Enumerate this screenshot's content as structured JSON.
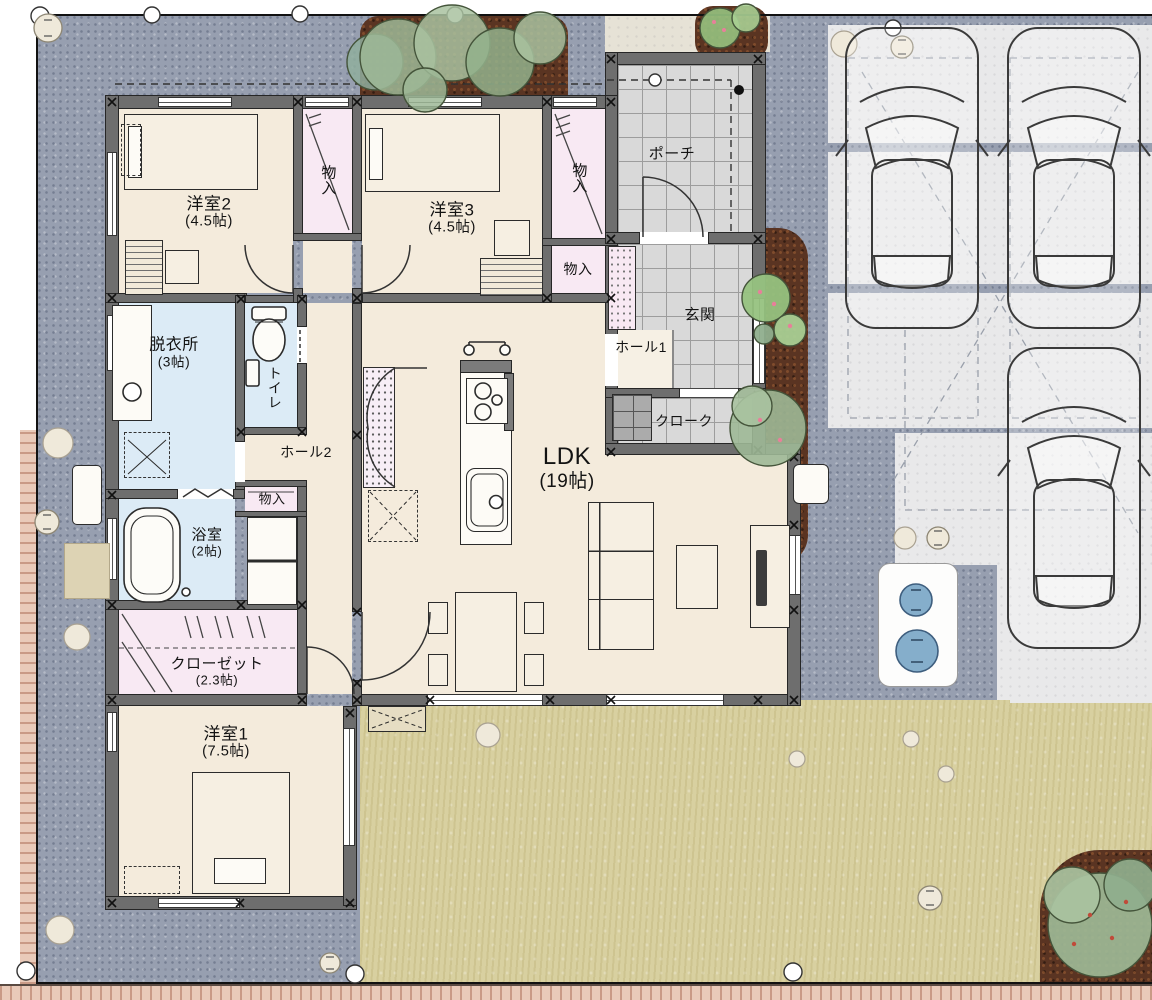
{
  "plan_type": "1F間取り図",
  "rooms": [
    {
      "id": "yoshitsu2",
      "name": "洋室2",
      "size": "(4.5帖)"
    },
    {
      "id": "mono_a",
      "name": "物入",
      "size": ""
    },
    {
      "id": "yoshitsu3",
      "name": "洋室3",
      "size": "(4.5帖)"
    },
    {
      "id": "mono_b",
      "name": "物入",
      "size": ""
    },
    {
      "id": "mono_c",
      "name": "物入",
      "size": ""
    },
    {
      "id": "porch",
      "name": "ポーチ",
      "size": ""
    },
    {
      "id": "genkan",
      "name": "玄関",
      "size": ""
    },
    {
      "id": "hall1",
      "name": "ホール1",
      "size": ""
    },
    {
      "id": "cloak",
      "name": "クローク",
      "size": ""
    },
    {
      "id": "datsuijo",
      "name": "脱衣所",
      "size": "(3帖)"
    },
    {
      "id": "toilet",
      "name": "トイレ",
      "size": ""
    },
    {
      "id": "hall2",
      "name": "ホール2",
      "size": ""
    },
    {
      "id": "mono_d",
      "name": "物入",
      "size": ""
    },
    {
      "id": "ldk",
      "name": "LDK",
      "size": "(19帖)"
    },
    {
      "id": "bath",
      "name": "浴室",
      "size": "(2帖)"
    },
    {
      "id": "closet",
      "name": "クローゼット",
      "size": "(2.3帖)"
    },
    {
      "id": "yoshitsu1",
      "name": "洋室1",
      "size": "(7.5帖)"
    }
  ],
  "site_features": {
    "cars": 3,
    "parking_joint_strips": 2,
    "water_tank_covers": 2,
    "tree_clusters": 4
  },
  "colors": {
    "floor_cream": "#f4ebdc",
    "closet_pink": "#f8e9f3",
    "wet_area_blue": "#dcebf6",
    "tile_gray": "#d9d9d9",
    "wall_gray": "#6e6e6e",
    "gravel": "#979fb0",
    "concrete": "#e9e9ea",
    "lawn": "#d8d0a0",
    "mulch_brown": "#5a3422",
    "tree_green": "#9db896",
    "fence_pink": "#e9cab9",
    "water_blue": "#85aecb"
  }
}
